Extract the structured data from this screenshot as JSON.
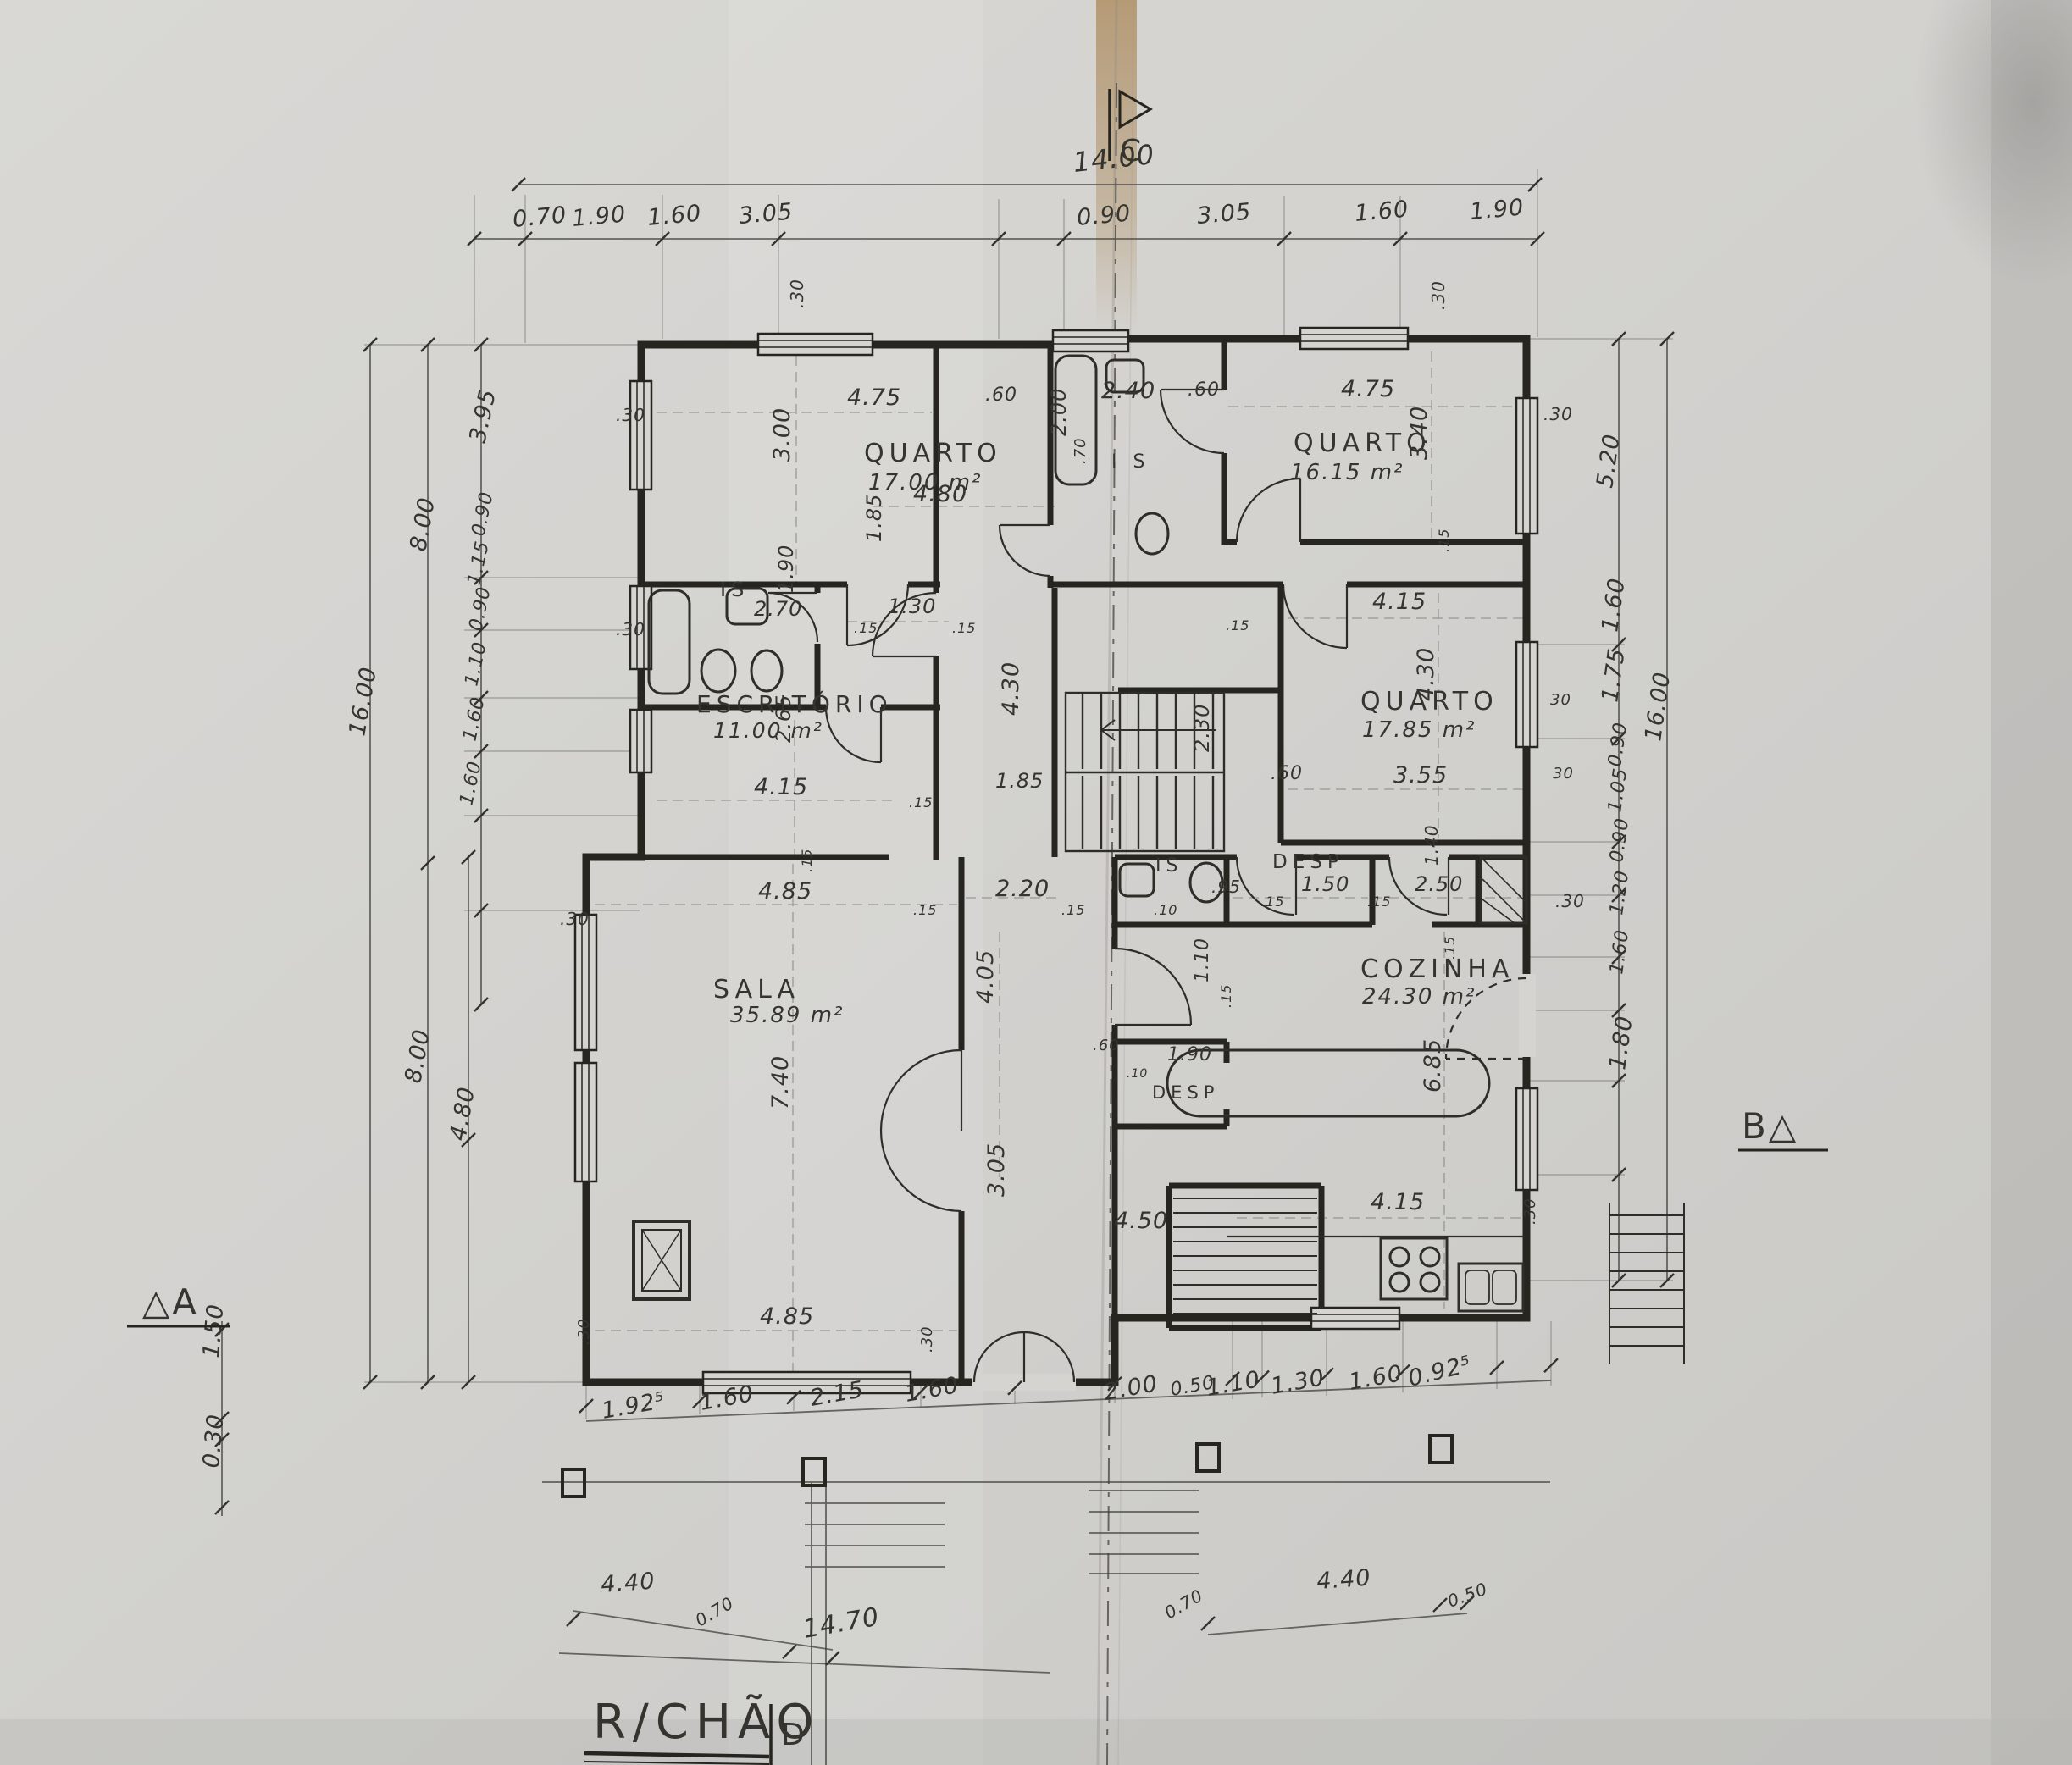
{
  "title": {
    "text": "R/CHÃO"
  },
  "section_markers": {
    "top": "C",
    "bottom": "D",
    "left": "△A",
    "right": "B△"
  },
  "rooms": [
    {
      "name": "QUARTO",
      "area": "17.00 m²"
    },
    {
      "name": "QUARTO",
      "area": "16.15 m²"
    },
    {
      "name": "QUARTO",
      "area": "17.85 m²"
    },
    {
      "name": "ESCRITÓRIO",
      "area": "11.00 m²"
    },
    {
      "name": "SALA",
      "area": "35.89 m²"
    },
    {
      "name": "COZINHA",
      "area": "24.30 m²"
    },
    {
      "name": "IS"
    },
    {
      "name": "I S"
    },
    {
      "name": "IS"
    },
    {
      "name": "DESP"
    },
    {
      "name": "DESP"
    }
  ],
  "dims": {
    "top_total": "14.00",
    "top": [
      "0.70",
      "1.90",
      "1.60",
      "3.05",
      "0.90",
      "3.05",
      "1.60",
      "1.90"
    ],
    "bottom": [
      "1.92⁵",
      "1.60",
      "2.15",
      "1.60",
      "2.00",
      "0.50",
      "1.10",
      "1.30",
      "1.60",
      "0.92⁵"
    ],
    "bottom_lower": [
      "4.40",
      "0.70",
      "14.70",
      "0.70",
      "4.40",
      "0.50"
    ],
    "left_outer": [
      "16.00",
      "8.00",
      "8.00",
      "4.80"
    ],
    "left_inner": [
      "3.95",
      "0.90",
      "1.15",
      "0.90",
      "1.10",
      "1.60",
      "1.60"
    ],
    "left_corner": [
      "1.50",
      "0.30"
    ],
    "right_outer": [
      "16.00"
    ],
    "right_inner": [
      "5.20",
      "1.60",
      "1.75",
      "0.90",
      "1.05",
      "0.90",
      "1.20",
      "1.60",
      "1.80"
    ],
    "interior": [
      "4.75",
      "3.00",
      ".60",
      "2.40",
      "2.00",
      ".70",
      "4.75",
      ".60",
      "3.40",
      ".30",
      ".30",
      ".30",
      ".30",
      "2.70",
      "1.90",
      "1.30",
      ".15",
      ".15",
      ".30",
      "2.65",
      "4.15",
      "4.80",
      "1.85",
      "4.30",
      "1.85",
      ".15",
      "2.20",
      ".15",
      ".15",
      "4.05",
      "4.15",
      ".15",
      "4.30",
      "3.55",
      ".60",
      "2.30",
      ".15",
      ".95",
      ".10",
      "1.50",
      "2.50",
      "1.40",
      ".15",
      ".15",
      ".30",
      "1.10",
      ".15",
      "1.90",
      ".60",
      ".10",
      "6.85",
      ".15",
      "4.15",
      "4.50",
      "3.05",
      "4.85",
      ".15",
      ".30",
      "7.40",
      "4.85",
      ".30",
      ".30",
      ".30",
      "30",
      "30"
    ]
  }
}
